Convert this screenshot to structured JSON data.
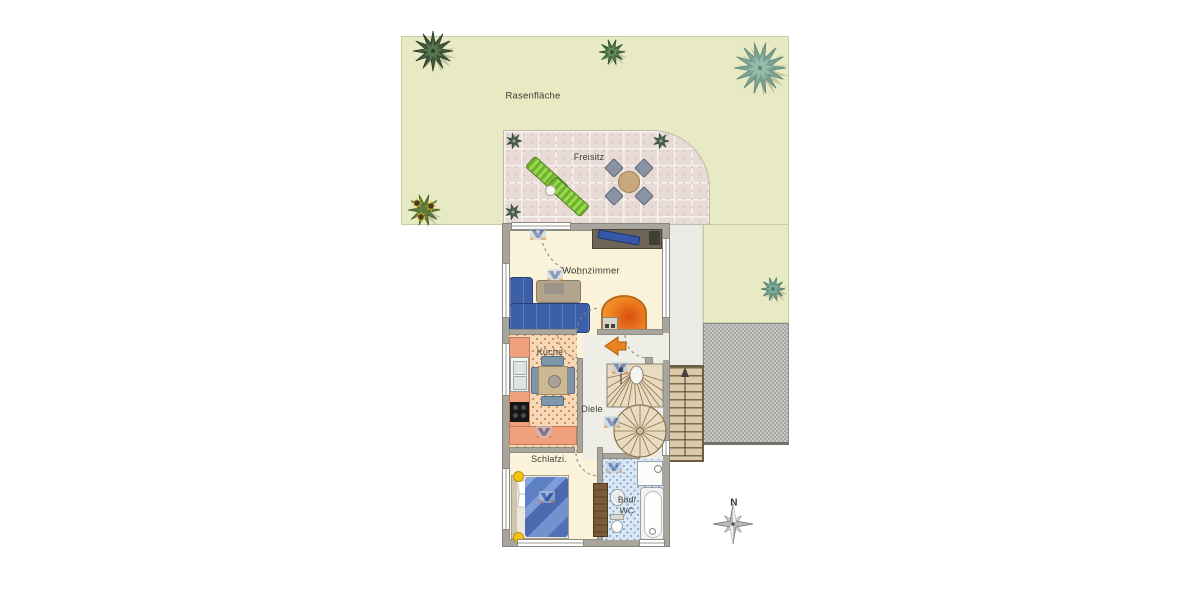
{
  "plan": {
    "garden": {
      "label": "Rasenfläche"
    },
    "patio": {
      "label": "Freisitz"
    },
    "rooms": {
      "living": {
        "label": "Wohnzimmer"
      },
      "kitchen": {
        "label": "Küche"
      },
      "hall": {
        "label": "Diele"
      },
      "bedroom": {
        "label": "Schlafzi."
      },
      "bath": {
        "line1": "Bad/",
        "line2": "WC"
      }
    },
    "compass": {
      "label": "N"
    }
  },
  "colors": {
    "garden": "#e7eac2",
    "patio_tile": "#e8dad5",
    "gravel": "#b5b5b5",
    "wall": "#a8a69c",
    "floor": "#faf2d9",
    "kitchen_floor": "#f7d8b9",
    "bath_floor": "#dbe8f4",
    "hall_floor": "#efeee6",
    "sofa": "#3c5fa8",
    "stove_orange": "#ef8322",
    "entrance_arrow": "#e8831d",
    "lounger": "#9ad94f",
    "counter": "#f1a07d",
    "stairs": "#e9dbbf",
    "stair_line": "#8a7050",
    "ext_stairs": "#dcc9a8",
    "bed": "#5d7fc4",
    "lamp": "#f2c410",
    "vr_blue": "#24429c",
    "vr_light": "#b9cfe3",
    "vr_orange": "#e07818",
    "tree_dark": "#41583b",
    "tree_teal": "#7ba495",
    "arc": "#8a8a80"
  },
  "icons": [
    "tree-icon",
    "sunflower-icon",
    "potted-plant-icon",
    "lounger-icon",
    "patio-table-icon",
    "patio-chair-icon",
    "compass-rose-icon",
    "north-arrow-icon",
    "entrance-arrow-icon",
    "door-swing-icon",
    "window-icon",
    "stair-icon",
    "spiral-stair-icon",
    "vr-watermark-icon",
    "sofa-icon",
    "tiled-stove-icon",
    "sink-icon",
    "stove-icon",
    "bed-icon",
    "bathtub-icon",
    "shower-icon",
    "toilet-icon",
    "washbasin-icon",
    "wardrobe-icon",
    "lamp-icon"
  ]
}
